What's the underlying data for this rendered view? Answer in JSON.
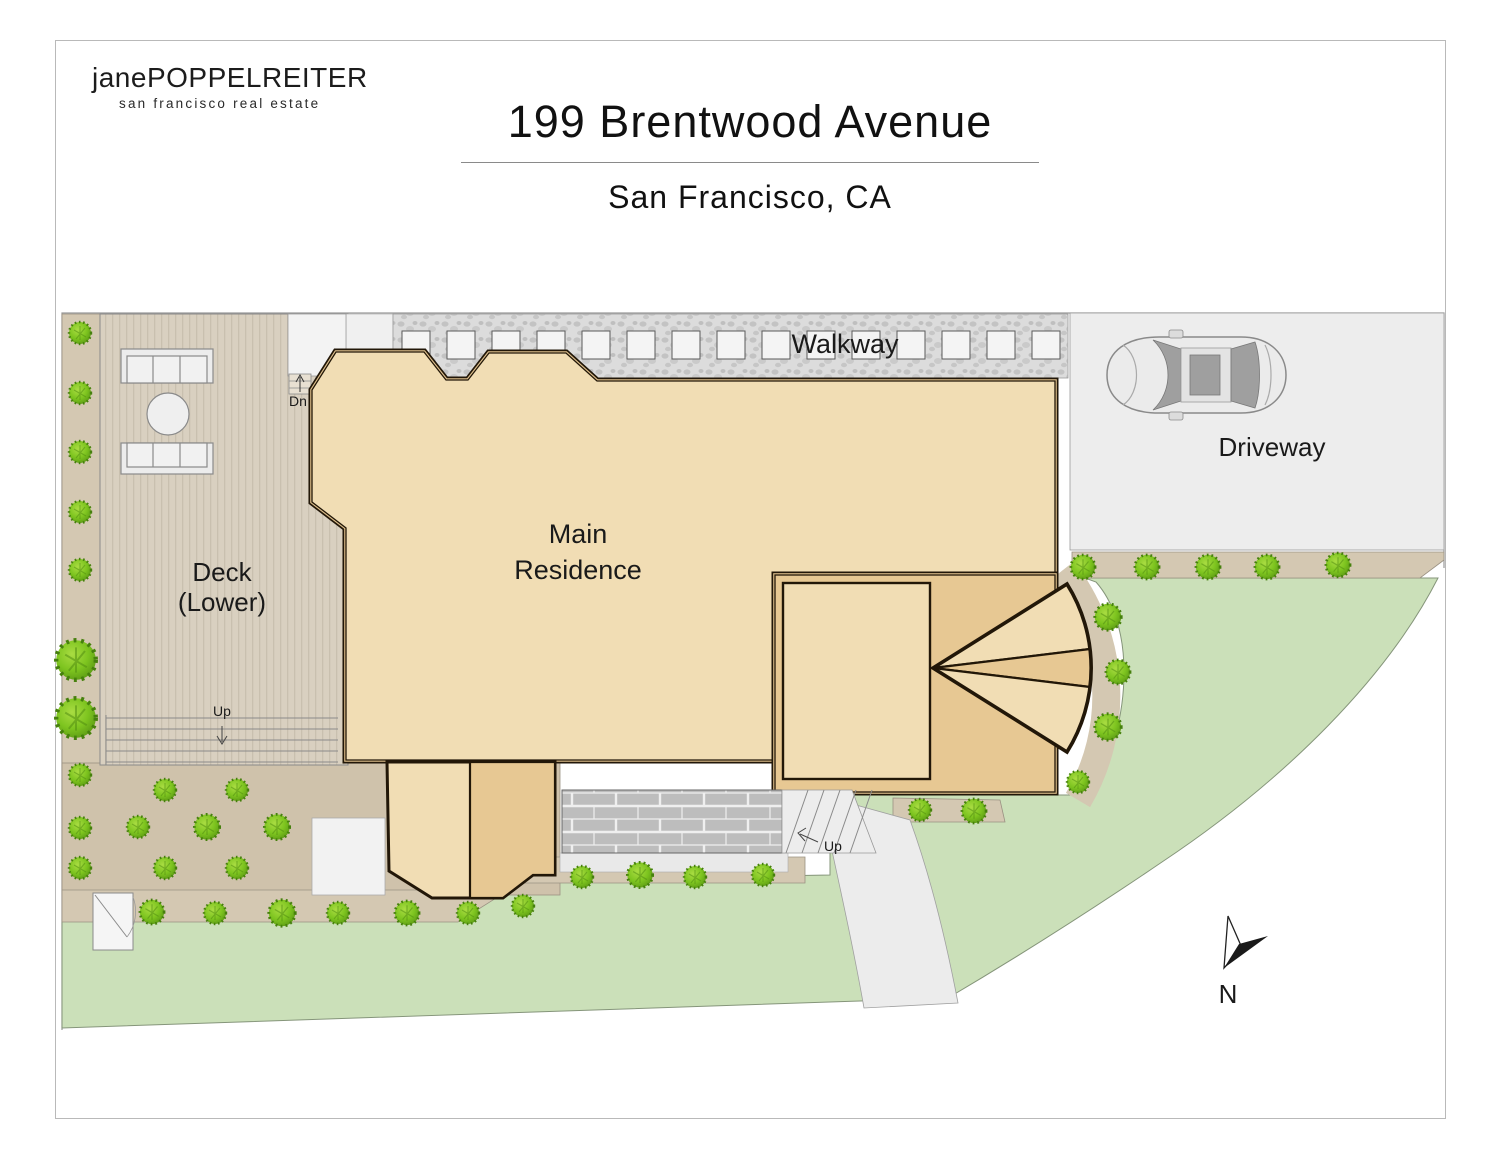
{
  "branding": {
    "logo_line1": "janePOPPELREITER",
    "logo_line2": "san francisco real estate"
  },
  "header": {
    "title": "199 Brentwood Avenue",
    "subtitle": "San Francisco, CA"
  },
  "plan": {
    "labels": {
      "main_residence_line1": "Main",
      "main_residence_line2": "Residence",
      "deck_line1": "Deck",
      "deck_line2": "(Lower)",
      "walkway": "Walkway",
      "driveway": "Driveway",
      "deck_stairs_up": "Up",
      "entry_stairs_up": "Up",
      "landing_stairs_down": "Dn",
      "north": "N"
    },
    "colors": {
      "building_light": "#f1ddb4",
      "building_dark": "#e7c893",
      "wall_outline": "#221708",
      "wall_band": "#dfc08d",
      "lawn": "#cbe0b9",
      "deck_wood": "#d9d0c0",
      "walkway_gray": "#dcdcdc",
      "paver_white": "#f4f4f4",
      "driveway_gray": "#ededed",
      "taupe_bed": "#d4c8b2",
      "patio_taupe": "#cfc2ab",
      "brick_gray": "#bdbdbd",
      "path_gray": "#ececec",
      "bush_green": "#7dc41f"
    }
  }
}
